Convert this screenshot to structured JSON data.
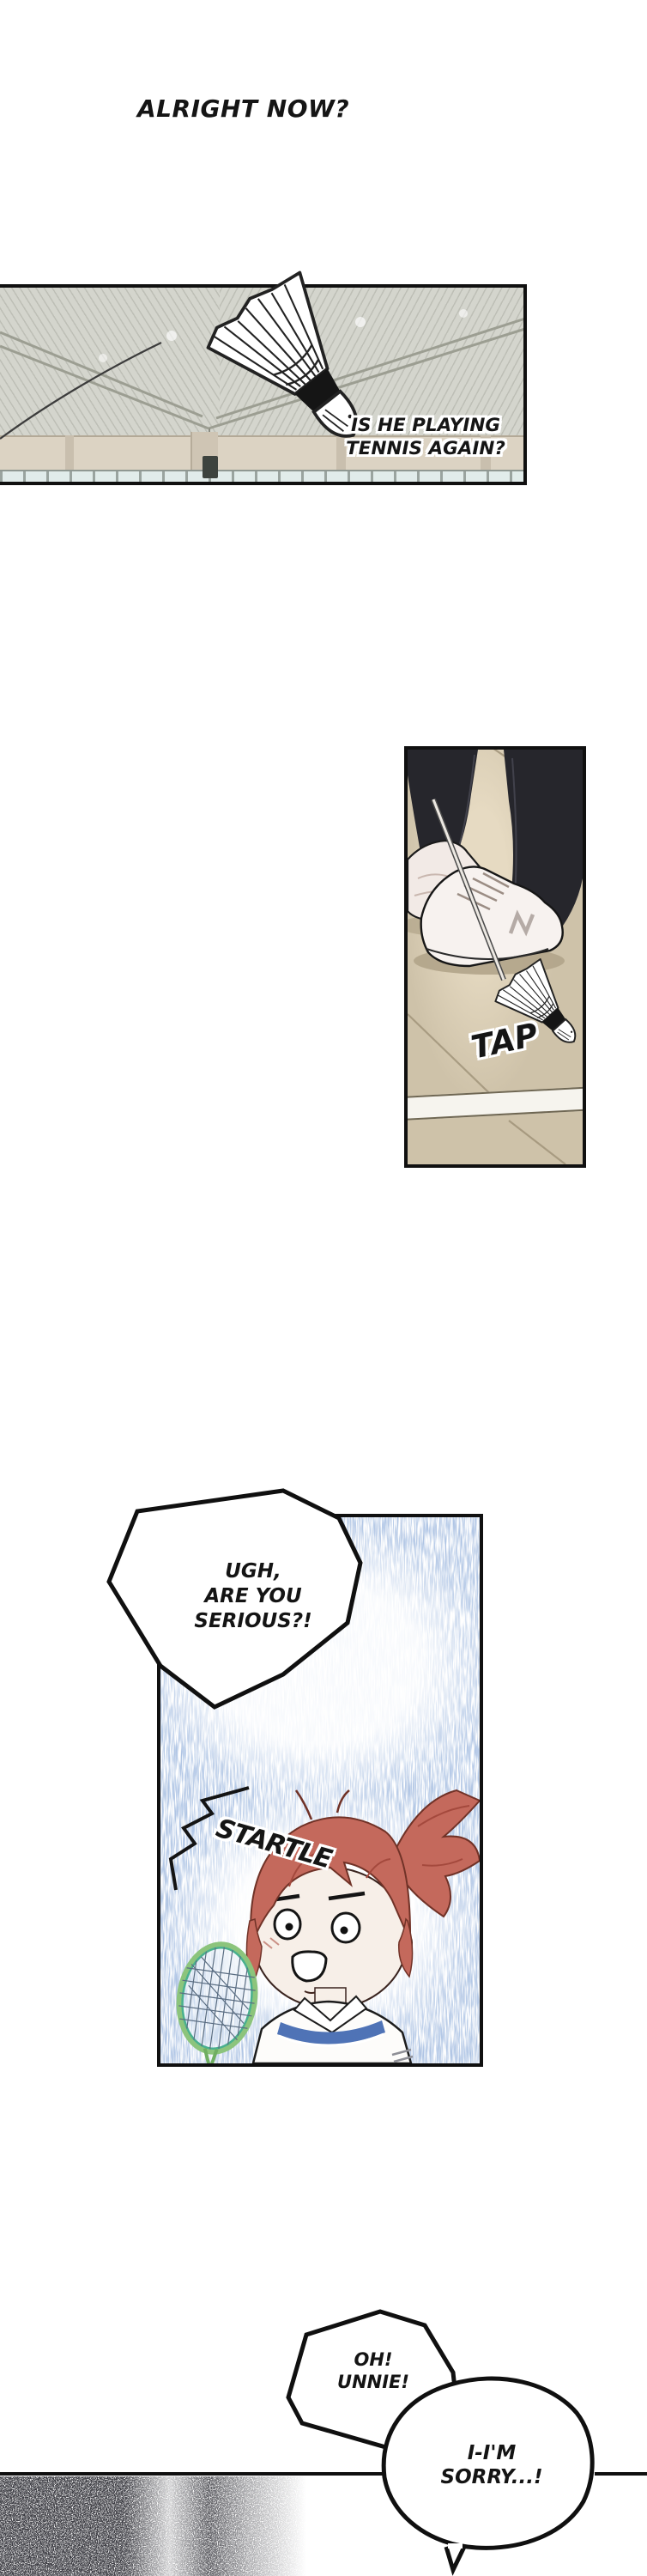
{
  "narration": {
    "text": "ALRIGHT NOW?"
  },
  "panel1": {
    "speech_line1": "IS HE PLAYING",
    "speech_line2": "TENNIS AGAIN?",
    "art": "badminton shuttlecock flying under gymnasium ceiling"
  },
  "panel2": {
    "sfx": "TAP",
    "art": "sneakers with racket tip tapping shuttlecock on court floor"
  },
  "panel3": {
    "bubble_line1": "UGH,",
    "bubble_line2": "ARE YOU",
    "bubble_line3": "SERIOUS?!",
    "sfx": "STARTLE",
    "art": "startled red-haired girl holding badminton racket in rain-streak gloom"
  },
  "bottom": {
    "bubble1_line1": "OH!",
    "bubble1_line2": "UNNIE!",
    "bubble2_line1": "I-I'M",
    "bubble2_line2": "SORRY...!"
  },
  "colors": {
    "ink": "#151515",
    "hair": "#c4695c",
    "rain_streak": "#7b97c6",
    "shirt_trim": "#4f73b6",
    "racket_frame": "#6fae62",
    "floor": "#cec2a9",
    "pants": "#26262c",
    "ceiling": "#d4d5cd",
    "wall": "#dcd3c3",
    "window": "#e1ecea"
  }
}
